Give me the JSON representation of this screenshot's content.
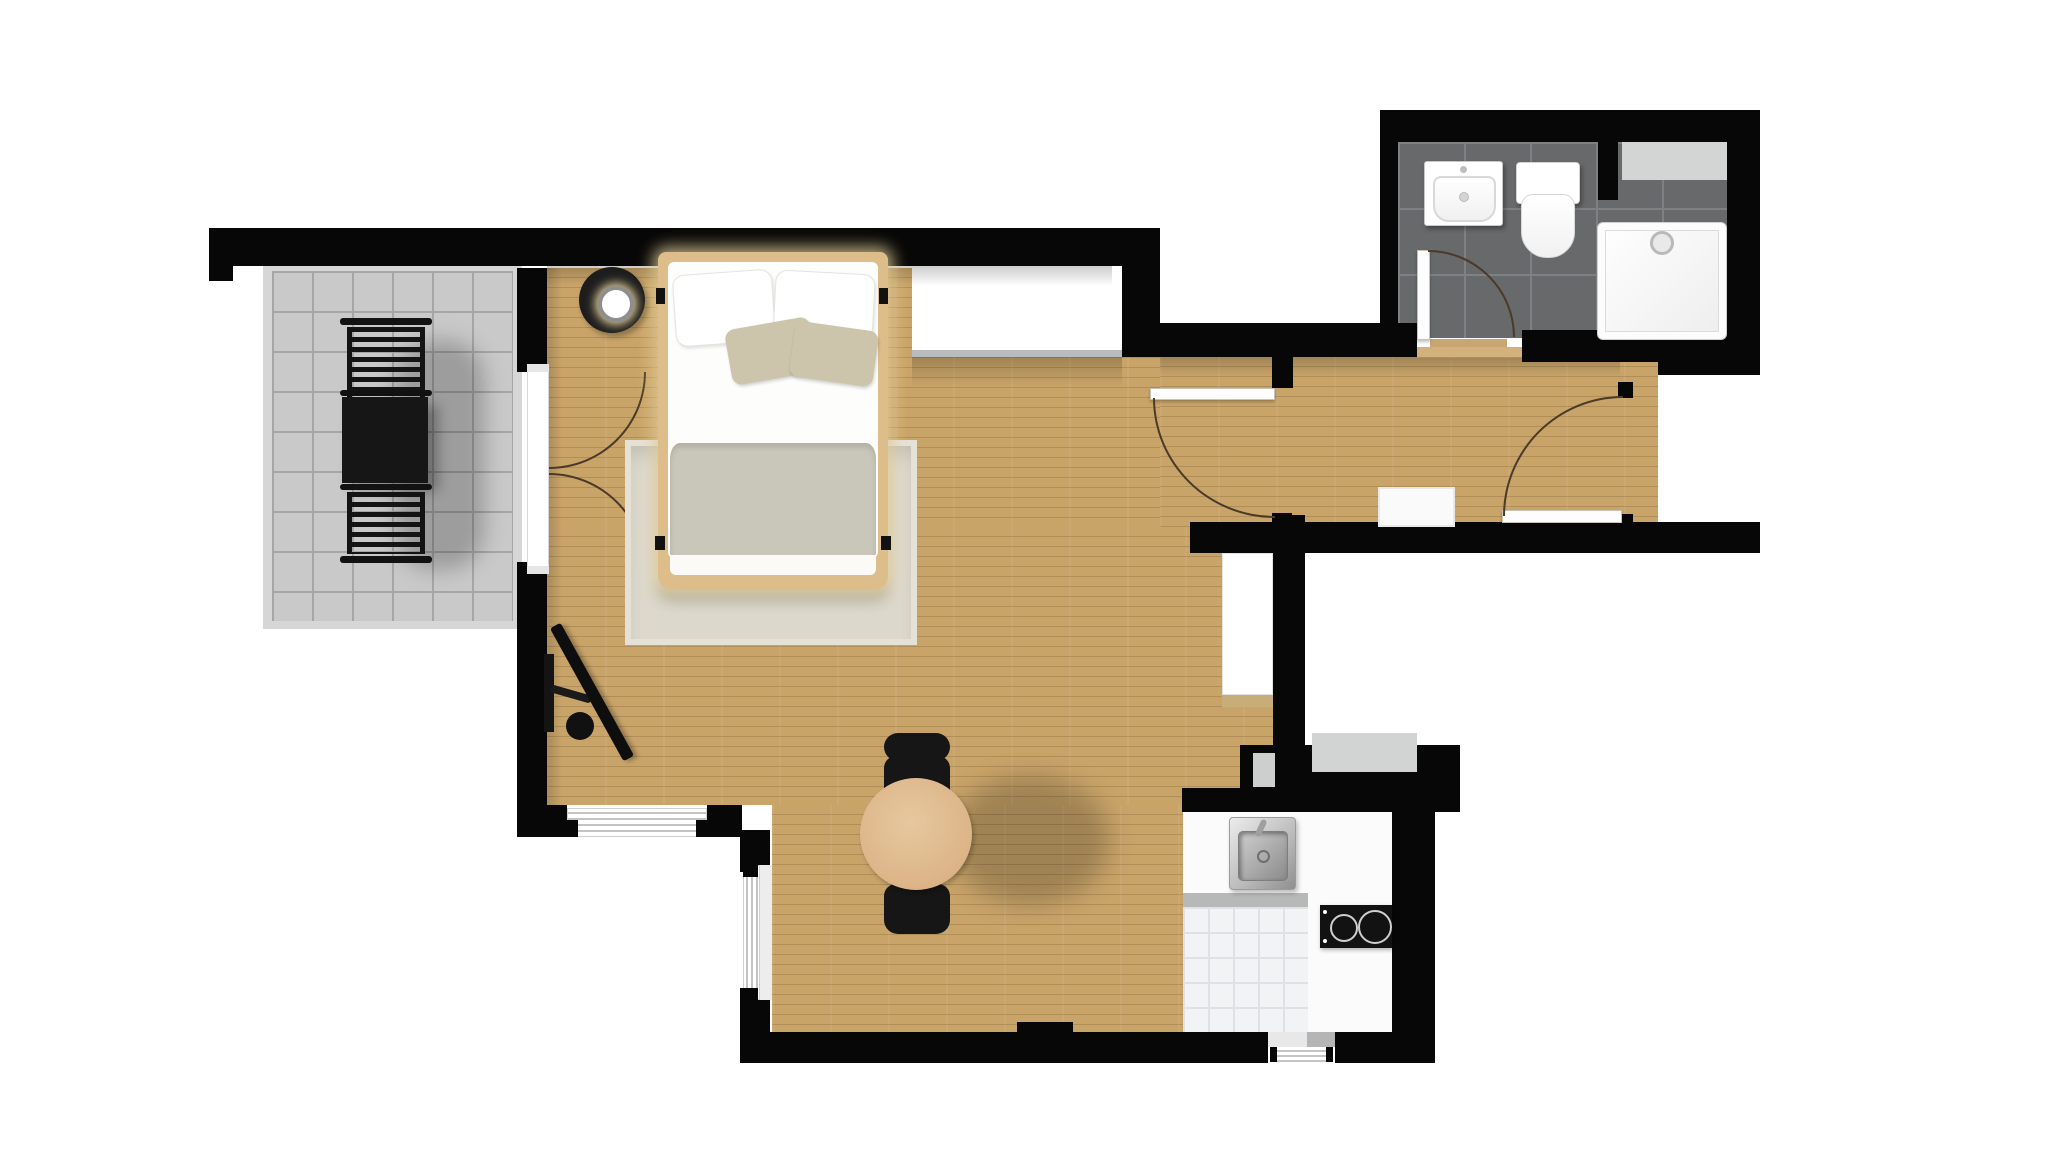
{
  "title": "Studio apartment floor plan, top-down view",
  "colors": {
    "wall": "#070707",
    "wood": "#c9a469",
    "wood-line": "#5c3e1938",
    "balcony-tile": "#c9c9c9",
    "balcony-grout": "#a6a6a6",
    "bath-tile": "#68696b",
    "bath-grout": "#7f8083",
    "kitchen-tile": "#f2f3f5",
    "kitchen-tile-line": "#dfe1e5",
    "kitchen-floor": "#fbfbfb",
    "counter": "#b7b9b9",
    "rug": "#dcd8cc",
    "bed-frame": "#ddbe8b",
    "bedding-white": "#fdfdfc",
    "blanket": "#c9c7b9",
    "pillow-beige": "#ccc5ab",
    "dining-table": "#dcb favorite88",
    "dining-table-fill": "#dcb488",
    "chair-black": "#161616",
    "appliance-gray": "#d2d4d4",
    "shelf-gray": "#d3d5d5",
    "door-arc": "#4a3a28",
    "steel-light": "#ececec",
    "steel-dark": "#8f8f8f",
    "glow": "#f8e3a8"
  },
  "rooms": [
    {
      "id": "balcony",
      "floor": "gray-stone-tiles",
      "furniture": [
        "outdoor-table",
        "outdoor-chair",
        "outdoor-chair"
      ]
    },
    {
      "id": "bedroom-living-room",
      "floor": "light-oak-plank",
      "furniture": [
        "double-bed",
        "side-table-with-lamp",
        "area-rug",
        "wall-tv",
        "built-in-wardrobe",
        "round-dining-table",
        "dining-chair",
        "dining-chair"
      ]
    },
    {
      "id": "hallway",
      "floor": "light-oak-plank",
      "furniture": [
        "doormat"
      ]
    },
    {
      "id": "bathroom",
      "floor": "dark-gray-tiles",
      "furniture": [
        "washbasin",
        "toilet",
        "shower-tray",
        "shelf"
      ]
    },
    {
      "id": "kitchen",
      "floor": "white-tiles",
      "furniture": [
        "steel-sink",
        "two-burner-hob",
        "counter"
      ]
    }
  ],
  "fixtures": {
    "doors": [
      "balcony-french-door",
      "bathroom-door",
      "hallway-door",
      "entry-door"
    ],
    "windows": [
      "living-window-south",
      "living-window-west-lower",
      "kitchen-window"
    ]
  }
}
